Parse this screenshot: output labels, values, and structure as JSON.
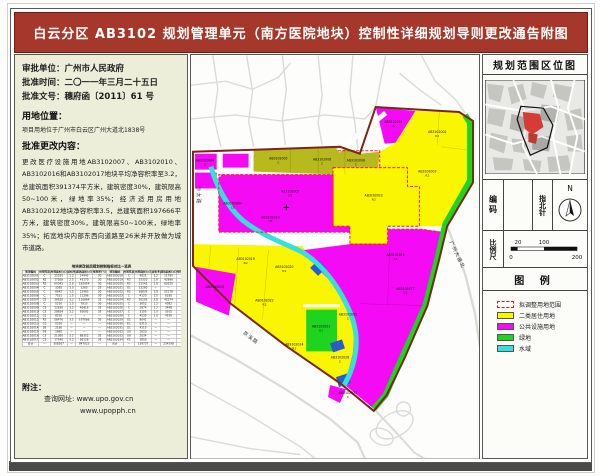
{
  "title": "白云分区 AB3102 规划管理单元（南方医院地块）控制性详细规划导则更改通告附图",
  "left": {
    "approval": {
      "unit": "审批单位：广州市人民政府",
      "date": "批准时间：二〇一一年三月二十五日",
      "doc": "批准文号：穗府函〔2011〕61 号"
    },
    "location": {
      "heading": "用地位置：",
      "text": "项目用地位于广州市白云区广州大道北1838号"
    },
    "changes": {
      "heading": "批准更改内容：",
      "text": "更改医疗设施用地AB3102007、AB3102010、AB3102016和AB3102017地块平均净容积率至3.2，总建筑面积391374平方米，建筑密度30%，建筑限高50~100米，绿地率35%；经济适用房用地AB3102012地块净容积率3.5，总建筑面积197666平方米，建筑密度30%，建筑限高50~100米，绿地率35%；拓宽地块内部东西向道路至26米并开放做为城市道路。"
    },
    "table": {
      "title": "地块更改前后规划控制指标对比一览表",
      "headers": [
        "地块编码",
        "用地性质",
        "用地面积(㎡)",
        "容积率",
        "建筑面积(㎡)",
        "绿地率(%)",
        "地块编码",
        "用地性质",
        "用地面积(㎡)",
        "容积率",
        "建筑面积(㎡)",
        "绿地率(%)"
      ],
      "rows": [
        [
          "AB3102001",
          "C",
          "12035",
          "1.2",
          "14442",
          "30",
          "AB3102018",
          "C",
          "9821",
          "1.2",
          "11785",
          "30"
        ],
        [
          "AB3102002",
          "R2",
          "17268",
          "2.5",
          "43170",
          "30",
          "AB3102019",
          "R2",
          "15320",
          "2.8",
          "42896",
          "30"
        ],
        [
          "AB3102003",
          "R2",
          "65341",
          "2.8",
          "182954",
          "30",
          "AB3102020",
          "R2",
          "21543",
          "2.8",
          "60320",
          "30"
        ],
        [
          "AB3102004",
          "C",
          "3265",
          "1.0",
          "3265",
          "25",
          "AB3102021",
          "G1",
          "13260",
          "—",
          "—",
          "—"
        ],
        [
          "AB3102005",
          "C",
          "8642",
          "1.5",
          "12963",
          "30",
          "AB3102022",
          "R2",
          "18635",
          "2.8",
          "52178",
          "30"
        ],
        [
          "AB3102006",
          "C",
          "7531",
          "1.5",
          "11296",
          "30",
          "AB3102023",
          "C",
          "4120",
          "1.5",
          "6180",
          "25"
        ],
        [
          "AB3102007",
          "C5",
          "36520",
          "3.2",
          "116864",
          "35",
          "AB3102024",
          "R2",
          "16205",
          "2.8",
          "45374",
          "30"
        ],
        [
          "AB3102008",
          "C",
          "5210",
          "1.5",
          "7815",
          "30",
          "AB3102025",
          "C",
          "3652",
          "1.2",
          "4382",
          "25"
        ],
        [
          "AB3102009",
          "C5",
          "12630",
          "3.2",
          "40416",
          "35",
          "AB3102026",
          "C",
          "2874",
          "1.2",
          "3448",
          "25"
        ],
        [
          "AB3102010",
          "C5",
          "28654",
          "3.2",
          "91692",
          "35",
          "AB3102027",
          "C",
          "3105",
          "1.0",
          "3105",
          "25"
        ],
        [
          "AB3102011",
          "G1",
          "6520",
          "—",
          "—",
          "—",
          "AB3102028",
          "C",
          "4530",
          "1.0",
          "4530",
          "25"
        ],
        [
          "AB3102012",
          "R2",
          "56476",
          "3.5",
          "197666",
          "35",
          "AB3102029",
          "G1",
          "8642",
          "—",
          "—",
          "—"
        ],
        [
          "AB3102013",
          "G1",
          "5230",
          "—",
          "—",
          "—",
          "AB3102030",
          "E1",
          "6310",
          "—",
          "—",
          "—"
        ],
        [
          "AB3102014",
          "S9",
          "2180",
          "—",
          "—",
          "—",
          "AB3102031",
          "G1",
          "4215",
          "—",
          "—",
          "—"
        ],
        [
          "AB3102015",
          "S9",
          "1865",
          "—",
          "—",
          "—",
          "AB3102032",
          "S9",
          "1620",
          "—",
          "—",
          "—"
        ],
        [
          "AB3102016",
          "C5",
          "21360",
          "3.2",
          "68352",
          "35",
          "AB3102033",
          "S9",
          "2034",
          "—",
          "—",
          "—"
        ],
        [
          "AB3102017",
          "C5",
          "17540",
          "3.2",
          "56128",
          "35",
          "AB3102034",
          "E1",
          "3856",
          "—",
          "—",
          "—"
        ],
        [
          "合计",
          "—",
          "308267",
          "—",
          "847023",
          "—",
          "合计",
          "—",
          "139737",
          "—",
          "234198",
          "—"
        ]
      ]
    },
    "notes": {
      "heading": "附注：",
      "url_label": "查询网址: www.upo.gov.cn",
      "url2": "www.upopph.cn"
    }
  },
  "map": {
    "parcels": [
      {
        "code": "AB3102001",
        "t": "C",
        "x": 204,
        "y": 68
      },
      {
        "code": "AB3102002",
        "t": "R2",
        "x": 248,
        "y": 78
      },
      {
        "code": "AB3102003",
        "t": "R2",
        "x": 238,
        "y": 118
      },
      {
        "code": "AB3102004",
        "t": "C",
        "x": 14,
        "y": 107
      },
      {
        "code": "AB3102005",
        "t": "C",
        "x": 88,
        "y": 105
      },
      {
        "code": "AB3102006",
        "t": "C",
        "x": 132,
        "y": 106
      },
      {
        "code": "AB3102008",
        "t": "C",
        "x": 166,
        "y": 107
      },
      {
        "code": "AB3102007",
        "t": "C5",
        "x": 100,
        "y": 138
      },
      {
        "code": "AB3102009",
        "t": "C5",
        "x": 42,
        "y": 150
      },
      {
        "code": "AB3102010",
        "t": "C5",
        "x": 80,
        "y": 164
      },
      {
        "code": "AB3102012",
        "t": "R2",
        "x": 184,
        "y": 142
      },
      {
        "code": "AB3102016",
        "t": "C5",
        "x": 206,
        "y": 202
      },
      {
        "code": "AB3102017",
        "t": "C5",
        "x": 216,
        "y": 236
      },
      {
        "code": "AB3102019",
        "t": "R2",
        "x": 55,
        "y": 206
      },
      {
        "code": "AB3102020",
        "t": "R2",
        "x": 94,
        "y": 214
      },
      {
        "code": "AB3102018",
        "t": "C",
        "x": 24,
        "y": 234
      },
      {
        "code": "AB3102022",
        "t": "R2",
        "x": 74,
        "y": 248
      },
      {
        "code": "AB3102021",
        "t": "G1",
        "x": 131,
        "y": 274
      },
      {
        "code": "AB3102024",
        "t": "R2",
        "x": 104,
        "y": 292
      },
      {
        "code": "AB3102025",
        "t": "C",
        "x": 158,
        "y": 262
      },
      {
        "code": "AB3102026",
        "t": "C",
        "x": 150,
        "y": 305
      },
      {
        "code": "AB3102027",
        "t": "C",
        "x": 158,
        "y": 341
      }
    ],
    "roads": [
      {
        "text": "沙太路",
        "x": 6,
        "y": 132,
        "rot": 90
      },
      {
        "text": "广州大道北",
        "x": 260,
        "y": 188,
        "rot": 64
      },
      {
        "text": "京溪路",
        "x": 52,
        "y": 280,
        "rot": 38
      }
    ]
  },
  "right": {
    "location_title": "规划范围区位图",
    "code_label": "编码",
    "code_value": "",
    "compass_label": "指北针",
    "compass_n": "N",
    "scale_label": "比例尺",
    "scale": {
      "tick_20": "20",
      "tick_100": "100",
      "tick_0": "0",
      "tick_200": "200"
    },
    "legend_title": "图 例",
    "legend": [
      {
        "label": "拟调整用地范围",
        "swatch": "dashed-red"
      },
      {
        "label": "二类居住用地",
        "swatch": "#FAF500"
      },
      {
        "label": "公共设施用地",
        "swatch": "#F50AF5"
      },
      {
        "label": "绿地",
        "swatch": "#1FD41F"
      },
      {
        "label": "水域",
        "swatch": "#35E0D8"
      }
    ]
  },
  "colors": {
    "title_red": "#A5382A",
    "residential_yellow": "#FAF500",
    "public_magenta": "#F50AF5",
    "olive": "#B7B91D",
    "green": "#1FD41F",
    "water_cyan": "#35E0D8",
    "blue": "#2A5CCB",
    "boundary": "#7C2518",
    "adjust_red_dash": "#FF1A1A"
  }
}
